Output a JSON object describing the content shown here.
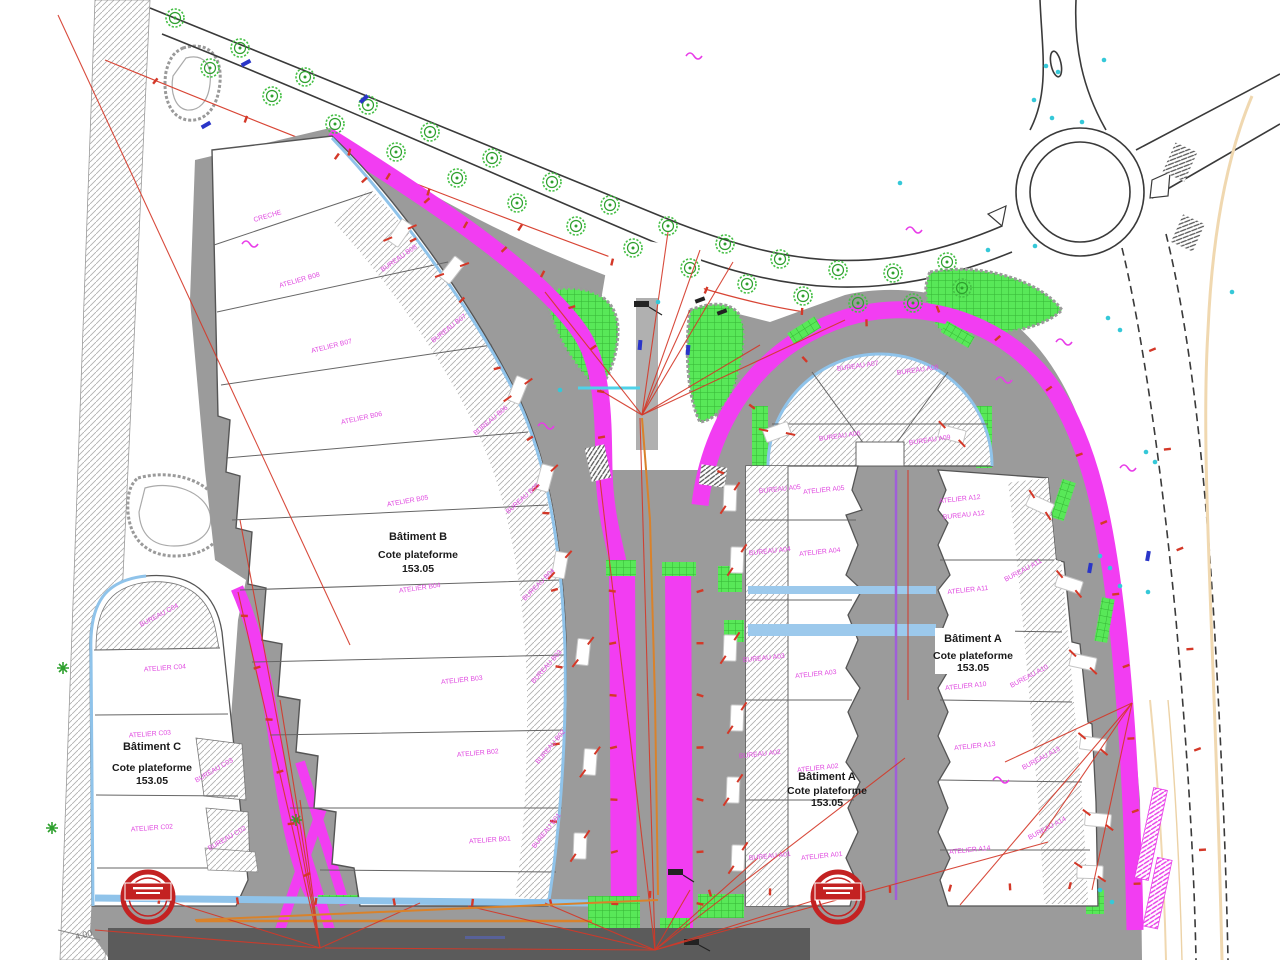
{
  "drawing": {
    "kind": "site-plan",
    "buildings": {
      "a": {
        "name": "Bâtiment A",
        "platform_label": "Cote plateforme",
        "platform_level": "153.05"
      },
      "b": {
        "name": "Bâtiment B",
        "platform_label": "Cote plateforme",
        "platform_level": "153.05"
      },
      "c": {
        "name": "Bâtiment C",
        "platform_label": "Cote plateforme",
        "platform_level": "153.05"
      }
    }
  },
  "titles": [
    {
      "line1": "Bâtiment B",
      "line2": "Cote plateforme",
      "line3": "153.05"
    },
    {
      "line1": "Bâtiment C",
      "line2": "Cote plateforme",
      "line3": "153.05"
    },
    {
      "line1": "Bâtiment A",
      "line2": "Cote plateforme",
      "line3": "153.05"
    },
    {
      "line1": "Bâtiment A",
      "line2": "Cote plateforme",
      "line3": "153.05"
    }
  ],
  "annotations": {
    "dimension": "4.00"
  },
  "colors": {
    "magenta_path": "#f23df2",
    "green_area": "#55e055",
    "pavement": "#9b9b9b",
    "dark_band": "#5b5b5b",
    "curb_blue": "#8fc3ea",
    "utility_red": "#d43828",
    "utility_orange": "#d9822b",
    "violet_line": "#a05fd8",
    "cyan_dot": "#35c8d8",
    "tan_line": "#f0d8b0",
    "sign_red": "#c32222",
    "label_magenta": "#e049e0"
  },
  "rooms": [
    {
      "label": "CRECHE",
      "x": 268,
      "y": 218,
      "r": -16
    },
    {
      "label": "ATELIER B08",
      "x": 300,
      "y": 282,
      "r": -16
    },
    {
      "label": "BUREAU B08",
      "x": 400,
      "y": 260,
      "r": -35
    },
    {
      "label": "ATELIER B07",
      "x": 332,
      "y": 348,
      "r": -14
    },
    {
      "label": "BUREAU B07",
      "x": 450,
      "y": 330,
      "r": -38
    },
    {
      "label": "ATELIER B06",
      "x": 362,
      "y": 420,
      "r": -12
    },
    {
      "label": "BUREAU B06",
      "x": 492,
      "y": 422,
      "r": -40
    },
    {
      "label": "ATELIER B05",
      "x": 408,
      "y": 503,
      "r": -10
    },
    {
      "label": "BUREAU B05",
      "x": 524,
      "y": 500,
      "r": -42
    },
    {
      "label": "ATELIER B04",
      "x": 420,
      "y": 590,
      "r": -8
    },
    {
      "label": "BUREAU B04",
      "x": 540,
      "y": 586,
      "r": -45
    },
    {
      "label": "ATELIER B03",
      "x": 462,
      "y": 682,
      "r": -6
    },
    {
      "label": "BUREAU B03",
      "x": 548,
      "y": 668,
      "r": -48
    },
    {
      "label": "ATELIER B02",
      "x": 478,
      "y": 755,
      "r": -5
    },
    {
      "label": "BUREAU B02",
      "x": 552,
      "y": 748,
      "r": -50
    },
    {
      "label": "ATELIER B01",
      "x": 490,
      "y": 842,
      "r": -4
    },
    {
      "label": "BUREAU B01",
      "x": 548,
      "y": 832,
      "r": -52
    },
    {
      "label": "BUREAU C04",
      "x": 160,
      "y": 617,
      "r": -28
    },
    {
      "label": "ATELIER C04",
      "x": 165,
      "y": 670,
      "r": -4
    },
    {
      "label": "ATELIER C03",
      "x": 150,
      "y": 736,
      "r": -4
    },
    {
      "label": "BUREAU C03",
      "x": 215,
      "y": 772,
      "r": -30
    },
    {
      "label": "ATELIER C02",
      "x": 152,
      "y": 830,
      "r": -4
    },
    {
      "label": "BUREAU C02",
      "x": 228,
      "y": 840,
      "r": -30
    },
    {
      "label": "BUREAU A07",
      "x": 858,
      "y": 368,
      "r": -8
    },
    {
      "label": "BUREAU A08",
      "x": 918,
      "y": 372,
      "r": -8
    },
    {
      "label": "BUREAU A06",
      "x": 840,
      "y": 438,
      "r": -8
    },
    {
      "label": "BUREAU A09",
      "x": 930,
      "y": 442,
      "r": -8
    },
    {
      "label": "BUREAU A05",
      "x": 780,
      "y": 491,
      "r": -6
    },
    {
      "label": "ATELIER A05",
      "x": 824,
      "y": 492,
      "r": -6
    },
    {
      "label": "BUREAU A04",
      "x": 770,
      "y": 553,
      "r": -6
    },
    {
      "label": "ATELIER A04",
      "x": 820,
      "y": 554,
      "r": -6
    },
    {
      "label": "BUREAU A03",
      "x": 764,
      "y": 660,
      "r": -6
    },
    {
      "label": "ATELIER A03",
      "x": 816,
      "y": 676,
      "r": -6
    },
    {
      "label": "BUREAU A02",
      "x": 760,
      "y": 756,
      "r": -6
    },
    {
      "label": "ATELIER A02",
      "x": 818,
      "y": 770,
      "r": -6
    },
    {
      "label": "BUREAU A01",
      "x": 770,
      "y": 858,
      "r": -6
    },
    {
      "label": "ATELIER A01",
      "x": 822,
      "y": 858,
      "r": -6
    },
    {
      "label": "ATELIER A12",
      "x": 960,
      "y": 501,
      "r": -6
    },
    {
      "label": "BUREAU A12",
      "x": 964,
      "y": 517,
      "r": -6
    },
    {
      "label": "BUREAU A11",
      "x": 1024,
      "y": 572,
      "r": -28
    },
    {
      "label": "ATELIER A11",
      "x": 968,
      "y": 592,
      "r": -6
    },
    {
      "label": "ATELIER A10",
      "x": 966,
      "y": 688,
      "r": -6
    },
    {
      "label": "BUREAU A10",
      "x": 1030,
      "y": 678,
      "r": -28
    },
    {
      "label": "ATELIER A13",
      "x": 975,
      "y": 748,
      "r": -6
    },
    {
      "label": "BUREAU A13",
      "x": 1042,
      "y": 760,
      "r": -28
    },
    {
      "label": "ATELIER A14",
      "x": 970,
      "y": 852,
      "r": -6
    },
    {
      "label": "BUREAU A14",
      "x": 1048,
      "y": 830,
      "r": -28
    }
  ],
  "signs": [
    {
      "name": "circular-red-sign",
      "x": 148,
      "y": 897
    },
    {
      "name": "circular-red-sign",
      "x": 838,
      "y": 897
    }
  ],
  "decorations": {
    "trees": [
      [
        175,
        18
      ],
      [
        240,
        48
      ],
      [
        305,
        77
      ],
      [
        368,
        105
      ],
      [
        430,
        132
      ],
      [
        492,
        158
      ],
      [
        552,
        182
      ],
      [
        610,
        205
      ],
      [
        668,
        226
      ],
      [
        725,
        244
      ],
      [
        780,
        259
      ],
      [
        838,
        270
      ],
      [
        893,
        273
      ],
      [
        947,
        262
      ],
      [
        210,
        68
      ],
      [
        272,
        96
      ],
      [
        335,
        124
      ],
      [
        396,
        152
      ],
      [
        457,
        178
      ],
      [
        517,
        203
      ],
      [
        576,
        226
      ],
      [
        633,
        248
      ],
      [
        690,
        268
      ],
      [
        747,
        284
      ],
      [
        803,
        296
      ],
      [
        858,
        303
      ],
      [
        913,
        303
      ],
      [
        962,
        288
      ]
    ],
    "shrubs": [
      [
        63,
        668
      ],
      [
        52,
        828
      ],
      [
        296,
        820
      ]
    ],
    "cars": [
      [
        400,
        233,
        -55
      ],
      [
        452,
        270,
        -52
      ],
      [
        518,
        390,
        -68
      ],
      [
        545,
        478,
        -75
      ],
      [
        560,
        565,
        -80
      ],
      [
        583,
        652,
        -84
      ],
      [
        590,
        762,
        -86
      ],
      [
        580,
        846,
        -88
      ],
      [
        730,
        498,
        -88
      ],
      [
        737,
        560,
        -88
      ],
      [
        730,
        648,
        -88
      ],
      [
        737,
        718,
        -88
      ],
      [
        733,
        790,
        -88
      ],
      [
        738,
        858,
        -88
      ],
      [
        777,
        432,
        -20
      ],
      [
        952,
        434,
        15
      ],
      [
        1040,
        505,
        25
      ],
      [
        1069,
        584,
        18
      ],
      [
        1083,
        662,
        12
      ],
      [
        1093,
        744,
        8
      ],
      [
        1098,
        820,
        5
      ],
      [
        1090,
        872,
        2
      ]
    ],
    "tick_paths": [
      {
        "pts": [
          [
            330,
            140
          ],
          [
            450,
            215
          ],
          [
            560,
            285
          ],
          [
            600,
            360
          ],
          [
            602,
            460
          ]
        ],
        "n": 10
      },
      {
        "pts": [
          [
            612,
            565
          ],
          [
            615,
            930
          ]
        ],
        "n": 7
      },
      {
        "pts": [
          [
            700,
            565
          ],
          [
            700,
            930
          ]
        ],
        "n": 7
      },
      {
        "pts": [
          [
            705,
            505
          ],
          [
            760,
            390
          ],
          [
            855,
            325
          ],
          [
            960,
            305
          ],
          [
            1045,
            380
          ],
          [
            1100,
            500
          ],
          [
            1125,
            650
          ],
          [
            1135,
            800
          ],
          [
            1138,
            920
          ]
        ],
        "n": 14
      },
      {
        "pts": [
          [
            238,
            590
          ],
          [
            265,
            700
          ],
          [
            290,
            820
          ],
          [
            315,
            900
          ]
        ],
        "n": 6
      },
      {
        "pts": [
          [
            120,
            900
          ],
          [
            400,
            902
          ],
          [
            590,
            903
          ]
        ],
        "n": 6
      },
      {
        "pts": [
          [
            620,
            895
          ],
          [
            1100,
            885
          ]
        ],
        "n": 8
      },
      {
        "pts": [
          [
            340,
            150
          ],
          [
            470,
            310
          ],
          [
            540,
            460
          ],
          [
            560,
            640
          ],
          [
            552,
            860
          ]
        ],
        "n": 10
      },
      {
        "pts": [
          [
            1145,
            300
          ],
          [
            1175,
            500
          ],
          [
            1195,
            700
          ],
          [
            1205,
            900
          ]
        ],
        "n": 6
      },
      {
        "pts": [
          [
            110,
            62
          ],
          [
            300,
            142
          ],
          [
            500,
            220
          ],
          [
            660,
            280
          ],
          [
            850,
            322
          ]
        ],
        "n": 8
      }
    ],
    "red_lines": [
      [
        58,
        15,
        350,
        645
      ],
      [
        908,
        470,
        908,
        700
      ],
      [
        642,
        415,
        545,
        292
      ],
      [
        642,
        415,
        600,
        390
      ],
      [
        642,
        415,
        668,
        232
      ],
      [
        642,
        415,
        700,
        250
      ],
      [
        642,
        415,
        733,
        262
      ],
      [
        642,
        415,
        690,
        310
      ],
      [
        642,
        415,
        760,
        345
      ],
      [
        642,
        415,
        845,
        320
      ],
      [
        655,
        950,
        640,
        418
      ],
      [
        655,
        950,
        600,
        480
      ],
      [
        655,
        950,
        690,
        890
      ],
      [
        655,
        950,
        758,
        858
      ],
      [
        655,
        950,
        838,
        893
      ],
      [
        655,
        950,
        545,
        903
      ],
      [
        655,
        950,
        468,
        906
      ],
      [
        655,
        950,
        325,
        948
      ],
      [
        655,
        950,
        905,
        758
      ],
      [
        655,
        950,
        1048,
        842
      ],
      [
        320,
        948,
        240,
        520
      ],
      [
        320,
        948,
        280,
        700
      ],
      [
        320,
        948,
        300,
        800
      ],
      [
        320,
        948,
        150,
        895
      ],
      [
        320,
        948,
        95,
        930
      ],
      [
        320,
        948,
        420,
        903
      ],
      [
        320,
        948,
        238,
        592
      ],
      [
        1132,
        703,
        1040,
        838
      ],
      [
        1132,
        703,
        1092,
        890
      ],
      [
        1132,
        703,
        1005,
        762
      ],
      [
        1132,
        703,
        960,
        905
      ]
    ],
    "orange_lines": [
      [
        642,
        418,
        650,
        520
      ],
      [
        650,
        520,
        655,
        700
      ],
      [
        655,
        700,
        658,
        895
      ],
      [
        658,
        900,
        195,
        920
      ]
    ],
    "cyan_dots": [
      [
        1046,
        66
      ],
      [
        1058,
        72
      ],
      [
        1034,
        100
      ],
      [
        1052,
        118
      ],
      [
        1082,
        122
      ],
      [
        1104,
        60
      ],
      [
        900,
        183
      ],
      [
        988,
        250
      ],
      [
        1035,
        246
      ],
      [
        1108,
        318
      ],
      [
        1120,
        330
      ],
      [
        1146,
        452
      ],
      [
        1155,
        462
      ],
      [
        1100,
        556
      ],
      [
        1110,
        568
      ],
      [
        1120,
        586
      ],
      [
        1148,
        592
      ],
      [
        1232,
        292
      ],
      [
        1100,
        890
      ],
      [
        1112,
        902
      ],
      [
        658,
        302
      ],
      [
        560,
        390
      ]
    ],
    "blue_dashes": [
      [
        246,
        63,
        -28
      ],
      [
        206,
        125,
        -30
      ],
      [
        364,
        99,
        -42
      ],
      [
        1090,
        568,
        -80
      ],
      [
        1148,
        556,
        -80
      ],
      [
        640,
        345,
        -85
      ],
      [
        688,
        350,
        -85
      ]
    ],
    "pink_squiggles": [
      [
        996,
        380
      ],
      [
        1056,
        342
      ],
      [
        538,
        426
      ],
      [
        242,
        244
      ],
      [
        1120,
        468
      ],
      [
        993,
        780
      ],
      [
        686,
        56
      ],
      [
        906,
        230
      ]
    ]
  }
}
